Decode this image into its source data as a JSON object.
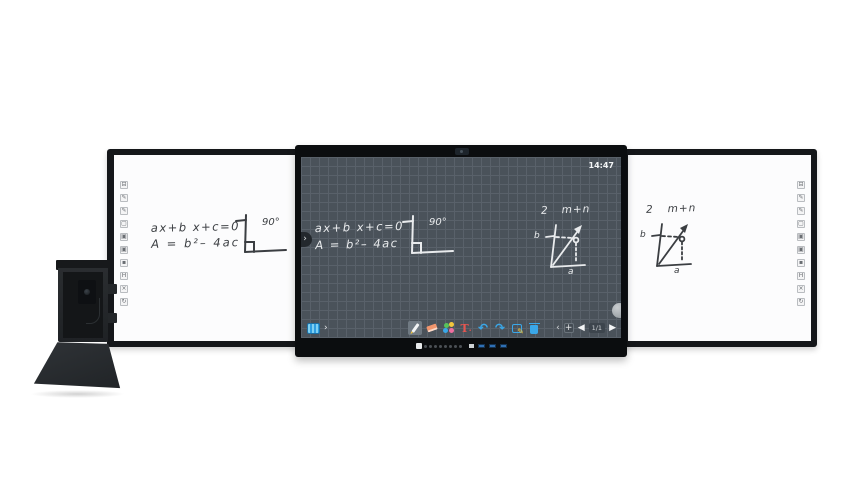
{
  "colors": {
    "screen_bg": "#4a525a",
    "grid_line": "#59616a",
    "bezel": "#0b0d0f",
    "frame": "#15171a",
    "accent_blue": "#3aa7e8",
    "chalk": "#e9ebed",
    "marker_ink": "#3b3e42",
    "eraser_orange": "#f0956d",
    "text_tool_red": "#e8554f"
  },
  "screen": {
    "time": "14:47",
    "writing": {
      "eq1": "ax+b x+c=0",
      "eq2": "A = b²– 4ac",
      "angle": "90°",
      "fig_num": "2",
      "fig_title": "m+n",
      "label_b": "b",
      "label_a": "a"
    },
    "edge": {
      "left_chevron": "›"
    },
    "toolbar": {
      "expand_chevron": "›",
      "collapse_chevron": "‹",
      "add_page": "+",
      "prev_arrow": "◀",
      "next_arrow": "▶",
      "page_indicator": "1/1",
      "undo_glyph": "↶",
      "redo_glyph": "↷",
      "text_tool_label": "T",
      "text_tool_dot": ".",
      "tools": [
        "whiteboard",
        "pen",
        "eraser",
        "palette",
        "text",
        "undo",
        "redo",
        "select",
        "delete"
      ]
    }
  },
  "left_wing": {
    "eq1": "ax+b x+c=0",
    "eq2": "A = b²– 4ac",
    "angle": "90°"
  },
  "right_wing": {
    "fig_num": "2",
    "fig_title": "m+n",
    "label_b": "b",
    "label_a": "a"
  },
  "side_strip": {
    "icons": [
      {
        "name": "board-minimize",
        "glyph": "⊟"
      },
      {
        "name": "pen-thin",
        "glyph": "✎"
      },
      {
        "name": "pen-thick",
        "glyph": "✎"
      },
      {
        "name": "page-blank",
        "glyph": "▢"
      },
      {
        "name": "eraser-small",
        "glyph": "▣"
      },
      {
        "name": "eraser-medium",
        "glyph": "▣"
      },
      {
        "name": "eraser-dot",
        "glyph": "▪"
      },
      {
        "name": "home-key",
        "glyph": "H"
      },
      {
        "name": "close-key",
        "glyph": "×"
      },
      {
        "name": "refresh-key",
        "glyph": "↻"
      }
    ]
  }
}
